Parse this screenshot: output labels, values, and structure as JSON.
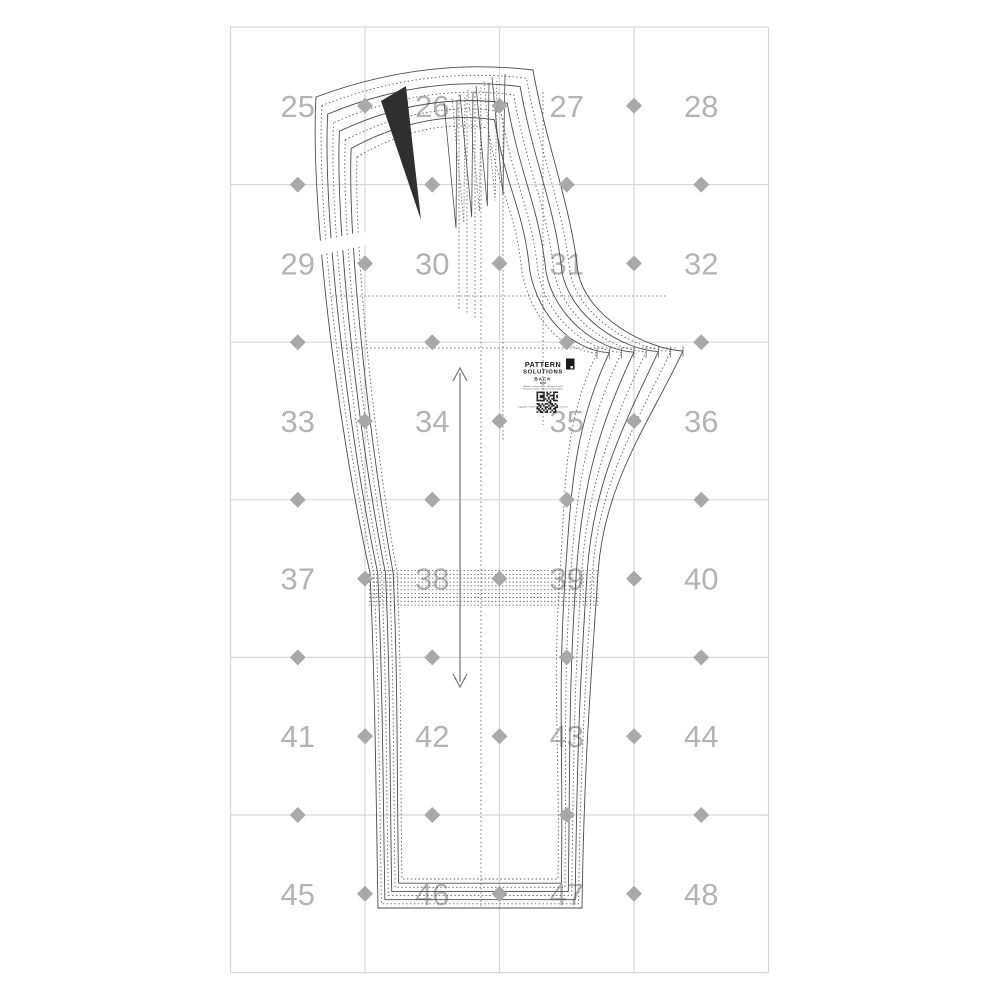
{
  "sheet": {
    "type": "sewing-pattern-tiled-sheet",
    "background": "#ffffff"
  },
  "grid": {
    "page_numbers": [
      "25",
      "26",
      "27",
      "28",
      "29",
      "30",
      "31",
      "32",
      "33",
      "34",
      "35",
      "36",
      "37",
      "38",
      "39",
      "40",
      "41",
      "42",
      "43",
      "44",
      "45",
      "46",
      "47",
      "48"
    ],
    "columns": 4,
    "rows": 6,
    "line_color": "#d7d7d7",
    "number_color": "#b3b3b3",
    "diamond_color": "#a8a8a8"
  },
  "pattern": {
    "piece_name": "BACK",
    "sizes_nested": 8,
    "outline_color": "#4a4a4a",
    "dotted_color": "#5f5f5f",
    "dart_fill": "#2f2f2f",
    "grainline_color": "#7d7d7d"
  },
  "label": {
    "brand_line1": "PATTERN",
    "brand_line2": "SOLUTIONS",
    "piece": "BACK",
    "style": "PANT",
    "desc_line1": "Women's trouser block - US sizes 0 to 18",
    "desc_line2": "For woven fabrics without stretch (cotton)",
    "copyright": "Copyright © 2023 Pattern Solutions. All rights reserved."
  },
  "icons": {
    "diamond": "alignment-diamond-icon",
    "grainline": "grainline-double-arrow-icon",
    "qr": "qr-code-icon",
    "logo": "brand-logo-square-icon"
  }
}
